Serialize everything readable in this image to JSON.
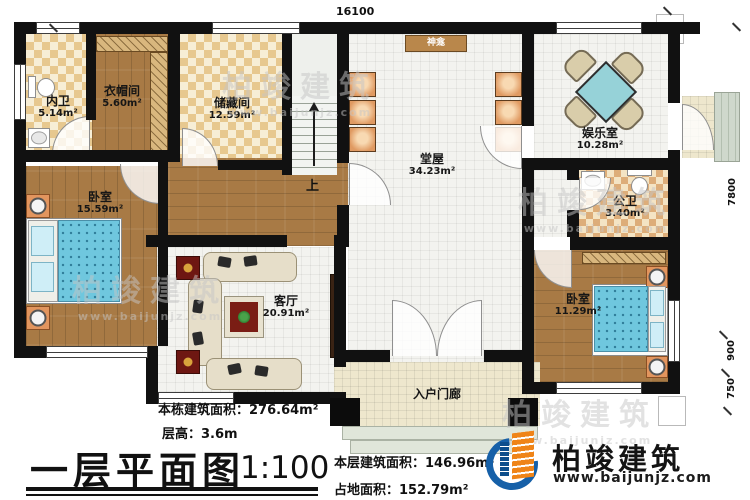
{
  "plan": {
    "dim_top": "16100",
    "dim_right_total": "7800",
    "dim_right_900": "900",
    "dim_right_750": "750",
    "stairs_up": "上",
    "shrine": "神龛"
  },
  "rooms": {
    "inner_bath": {
      "name": "内卫",
      "area": "5.14m²"
    },
    "cloakroom": {
      "name": "衣帽间",
      "area": "5.60m²"
    },
    "storage": {
      "name": "储藏间",
      "area": "12.59m²"
    },
    "bedroom_left": {
      "name": "卧室",
      "area": "15.59m²"
    },
    "hall": {
      "name": "堂屋",
      "area": "34.23m²"
    },
    "game_room": {
      "name": "娱乐室",
      "area": "10.28m²"
    },
    "public_bath": {
      "name": "公卫",
      "area": "3.40m²"
    },
    "bedroom_right": {
      "name": "卧室",
      "area": "11.29m²"
    },
    "living_room": {
      "name": "客厅",
      "area": "20.91m²"
    },
    "porch": {
      "name": "入户门廊"
    }
  },
  "footer": {
    "total_area_label": "本栋建筑面积：276.64m²",
    "floor_height_label": "层高：3.6m",
    "title": "一层平面图",
    "scale": "1:100",
    "floor_area_label": "本层建筑面积：146.96m²",
    "land_area_label": "占地面积：152.79m²"
  },
  "brand": {
    "name": "柏竣建筑",
    "website": "www.baijunjz.com"
  },
  "watermark": {
    "name": "柏竣建筑",
    "website": "www.baijunjz.com"
  },
  "colors": {
    "wall": "#111111",
    "wood_floor": "#a87a45",
    "checker_dark": "#e7c88f",
    "checker_light": "#f7eed6",
    "tile": "#f3f3ef",
    "bed_teal": "#6fc7de",
    "table_teal": "#96d2d8",
    "porch_tan": "#eee7cd",
    "chair_orange": "#e09a62",
    "brand_blue": "#1660a8",
    "brand_orange": "#ef8418"
  }
}
